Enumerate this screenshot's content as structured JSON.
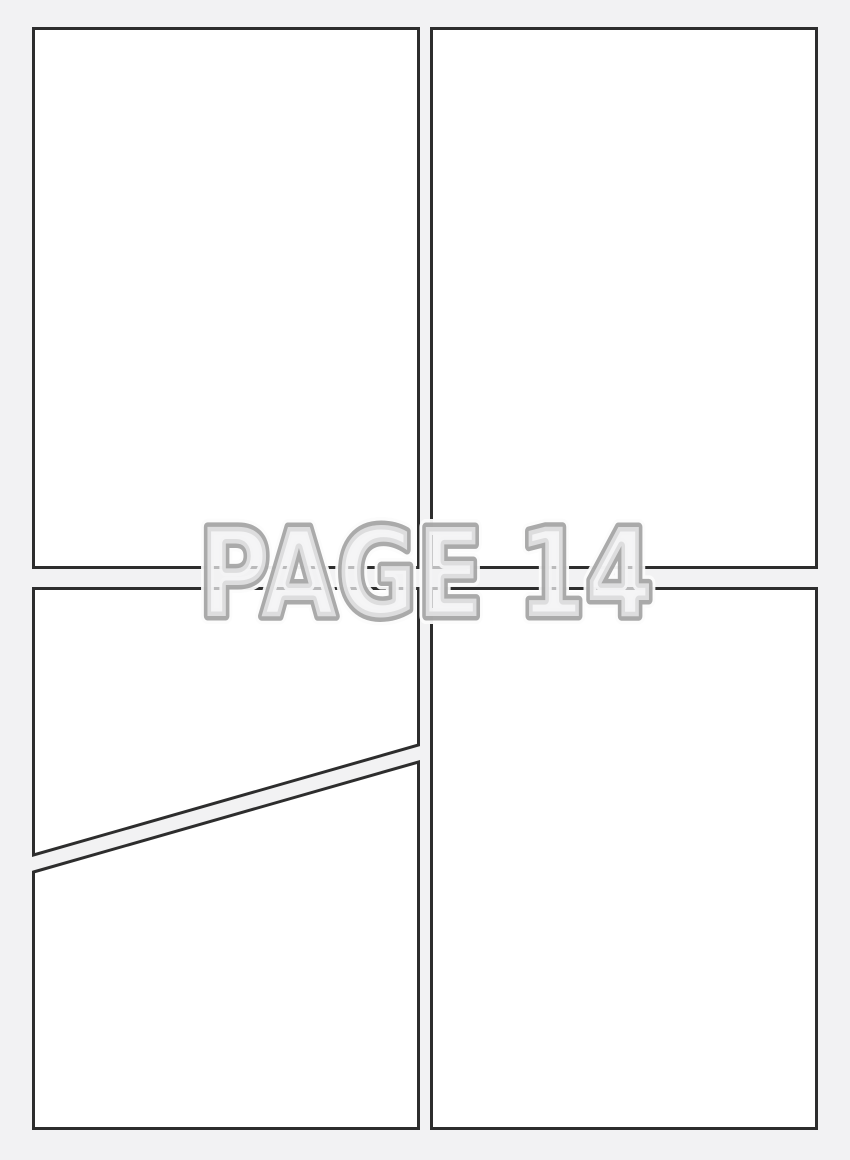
{
  "watermark": {
    "text": "PAGE 14",
    "page_number": "14"
  },
  "panels": [
    {
      "id": "top-left",
      "shape": "rectangle"
    },
    {
      "id": "top-right",
      "shape": "rectangle"
    },
    {
      "id": "bottom-left-upper",
      "shape": "polygon-diagonal-bottom-edge"
    },
    {
      "id": "bottom-left-lower",
      "shape": "polygon-diagonal-top-edge"
    },
    {
      "id": "bottom-right",
      "shape": "rectangle"
    }
  ],
  "colors": {
    "background": "#f2f2f3",
    "panel_fill": "#ffffff",
    "panel_border": "#2d2d2d",
    "watermark_fill": "#f1f1f2",
    "watermark_outline": "#9c9c9c",
    "watermark_halo": "#fcfcfc"
  }
}
